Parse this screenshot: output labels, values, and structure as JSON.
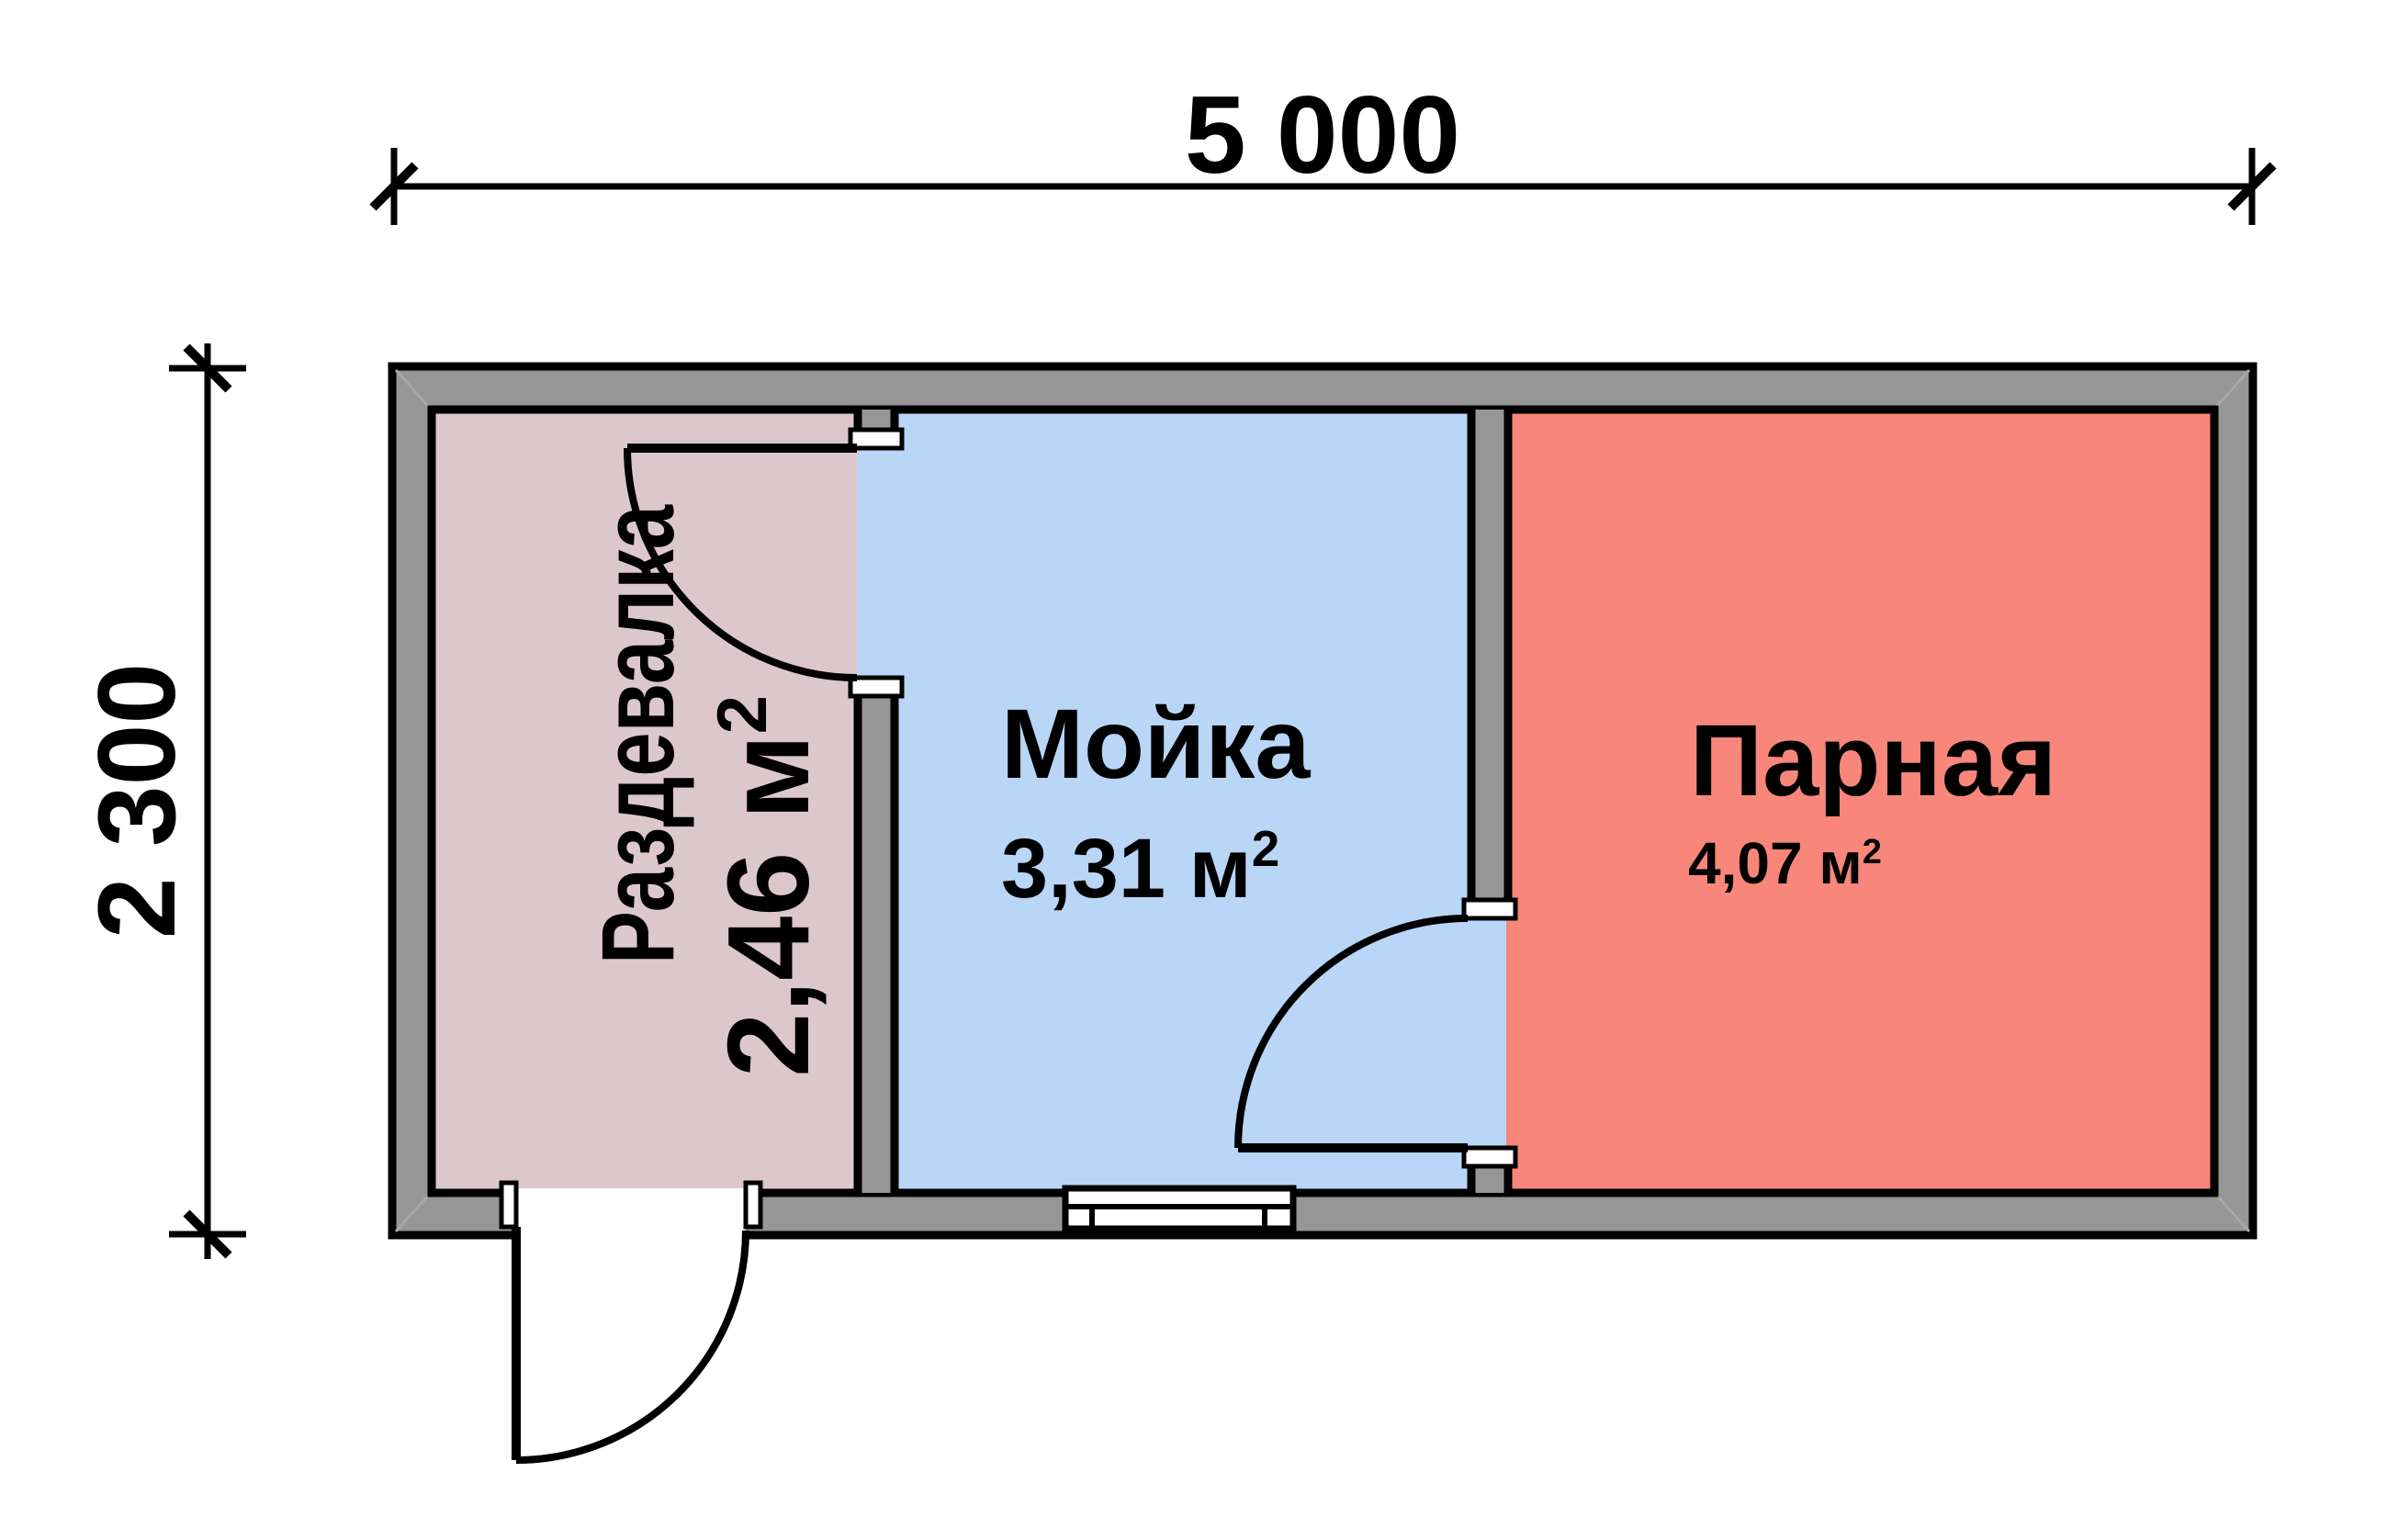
{
  "dimensions": {
    "overall_width_label": "5 000",
    "overall_height_label": "2 300"
  },
  "rooms": [
    {
      "name": "Раздевалка",
      "area": "2,46 м",
      "area_superscript": "2",
      "fill": "#dcc8cc"
    },
    {
      "name": "Мойка",
      "area": "3,31 м",
      "area_superscript": "2",
      "fill": "#b9d6f7"
    },
    {
      "name": "Парная",
      "area": "4,07 м",
      "area_superscript": "2",
      "fill": "#f8867b"
    }
  ],
  "palette": {
    "wall": "#969696",
    "outline": "#000000",
    "opening": "#ffffff",
    "background": "#ffffff",
    "corner_miter": "#a8a8a8"
  }
}
